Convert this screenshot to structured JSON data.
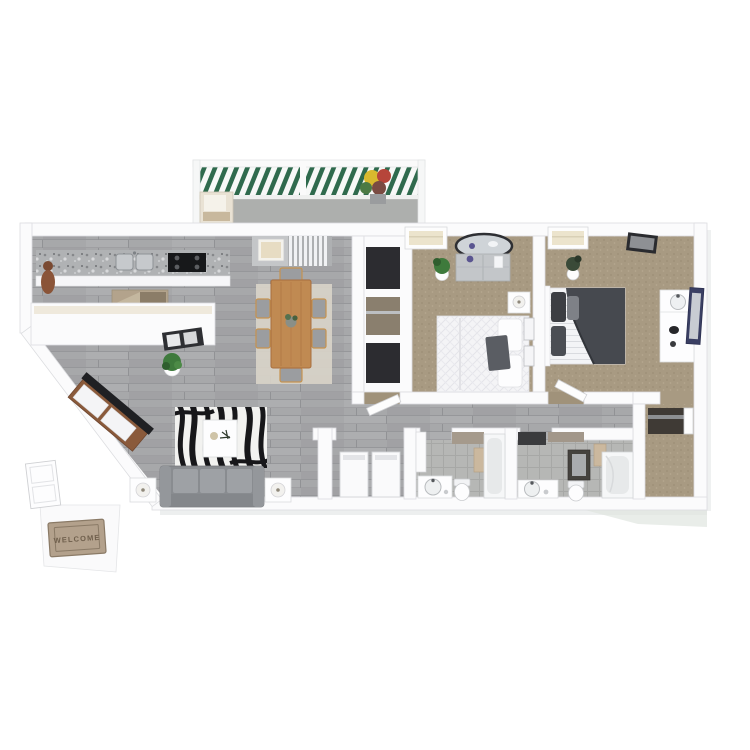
{
  "image": {
    "kind": "3d-rendered-floor-plan",
    "description-visible-text-only": "floor plan rendering; only legible text is the door mat",
    "background": "#ffffff"
  },
  "welcome_mat": {
    "text": "WELCOME"
  },
  "colors": {
    "wall": "#fbfbfc",
    "wood_floor": "#a7a8aa",
    "carpet": "#a89a82",
    "bathroom_tile": "#b6b7b5",
    "balcony_concrete": "#b8bab8",
    "railing_green": "#2f6a4d",
    "granite_counter": "#b0b2b4",
    "dining_table_wood": "#c08a52",
    "sofa_gray": "#898c90",
    "duvet_charcoal": "#46494f",
    "zebra_stripe": "#17171a",
    "rug_white": "#f2f2f0",
    "mat": "#b3a18c",
    "mat_text_color": "#6f5f4c",
    "tv_black": "#1f2023",
    "plant_green": "#3e7a3c",
    "mirror_navy": "#3a3f63",
    "range_black": "#17181a"
  },
  "rooms": [
    {
      "name": "balcony",
      "floor": "concrete",
      "items": [
        "railing",
        "lounge-chair",
        "flower-pot"
      ]
    },
    {
      "name": "kitchen",
      "floor": "wood",
      "items": [
        "granite-counter",
        "double-sink",
        "range",
        "peninsula-bar",
        "kitchen-rug",
        "wall-sculpture"
      ]
    },
    {
      "name": "dining-area",
      "floor": "wood",
      "items": [
        "dining-table",
        "dining-chairs",
        "area-rug",
        "vertical-blinds",
        "wall-art"
      ]
    },
    {
      "name": "living-room",
      "floor": "wood",
      "items": [
        "sofa",
        "zebra-rug",
        "coffee-table",
        "tv-console",
        "end-table-lamp-left",
        "end-table-lamp-right",
        "console-tray",
        "floor-plant"
      ]
    },
    {
      "name": "entry",
      "floor": "wood",
      "items": [
        "front-door",
        "landing",
        "welcome-mat"
      ]
    },
    {
      "name": "hallway",
      "floor": "wood",
      "items": [
        "hall-closets",
        "bedroom-doors"
      ]
    },
    {
      "name": "bedroom-1",
      "floor": "carpet",
      "items": [
        "bed-white",
        "nightstand-lamp",
        "dresser",
        "oval-mirror",
        "plant",
        "window",
        "wall-frames"
      ]
    },
    {
      "name": "bedroom-2",
      "floor": "carpet",
      "items": [
        "bed-charcoal",
        "vanity-sink",
        "wall-mirror",
        "plant",
        "window",
        "wall-art"
      ]
    },
    {
      "name": "bathroom-1",
      "floor": "tile",
      "items": [
        "vanity-sink",
        "toilet",
        "bathtub",
        "towels",
        "door"
      ]
    },
    {
      "name": "bathroom-2",
      "floor": "tile",
      "items": [
        "vanity-sink",
        "toilet",
        "bathtub",
        "towels",
        "medicine-cabinet"
      ]
    },
    {
      "name": "laundry-closet",
      "floor": "wood",
      "items": [
        "washer",
        "dryer"
      ]
    },
    {
      "name": "walk-in-closet",
      "floor": "carpet",
      "items": [
        "shelf-unit",
        "door"
      ]
    }
  ]
}
